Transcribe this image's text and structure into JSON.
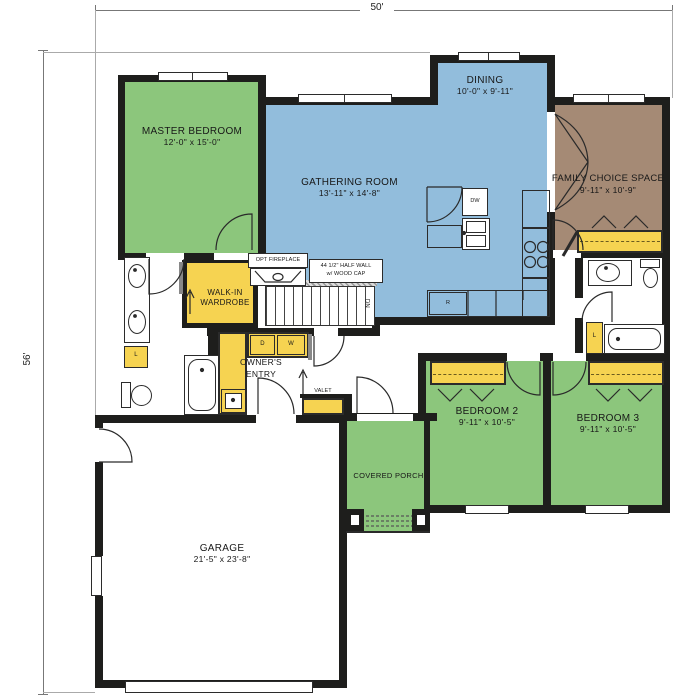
{
  "title": "Single-story floor plan",
  "dimensions": {
    "overall_width": "50'",
    "overall_height": "56'"
  },
  "rooms": {
    "master_bedroom": {
      "name": "MASTER BEDROOM",
      "size": "12'-0\" x 15'-0\""
    },
    "gathering_room": {
      "name": "GATHERING ROOM",
      "size": "13'-11\" x 14'-8\""
    },
    "dining": {
      "name": "DINING",
      "size": "10'-0\" x 9'-11\""
    },
    "family_choice_space": {
      "name": "FAMILY CHOICE SPACE",
      "size": "9'-11\" x 10'-9\""
    },
    "bedroom_2": {
      "name": "BEDROOM 2",
      "size": "9'-11\" x 10'-5\""
    },
    "bedroom_3": {
      "name": "BEDROOM 3",
      "size": "9'-11\" x 10'-5\""
    },
    "garage": {
      "name": "GARAGE",
      "size": "21'-5\" x 23'-8\""
    },
    "covered_porch": {
      "name": "COVERED PORCH"
    },
    "walk_in_wardrobe": {
      "line1": "WALK-IN",
      "line2": "WARDROBE"
    },
    "owners_entry": {
      "line1": "OWNER'S",
      "line2": "ENTRY"
    }
  },
  "annotations": {
    "opt_fireplace": "OPT FIREPLACE",
    "half_wall_line1": "44 1/2\" HALF WALL",
    "half_wall_line2": "w/ WOOD CAP",
    "valet": "VALET",
    "stairs_down": "DN",
    "dryer": "D",
    "washer": "W",
    "dishwasher": "DW",
    "refrigerator": "R",
    "linen": "L"
  },
  "colors": {
    "bedroom_green": "#8cc67c",
    "living_blue": "#92bddc",
    "closet_yellow": "#f6d351",
    "flex_brown": "#a58a75",
    "wall_black": "#1e1e1c"
  }
}
